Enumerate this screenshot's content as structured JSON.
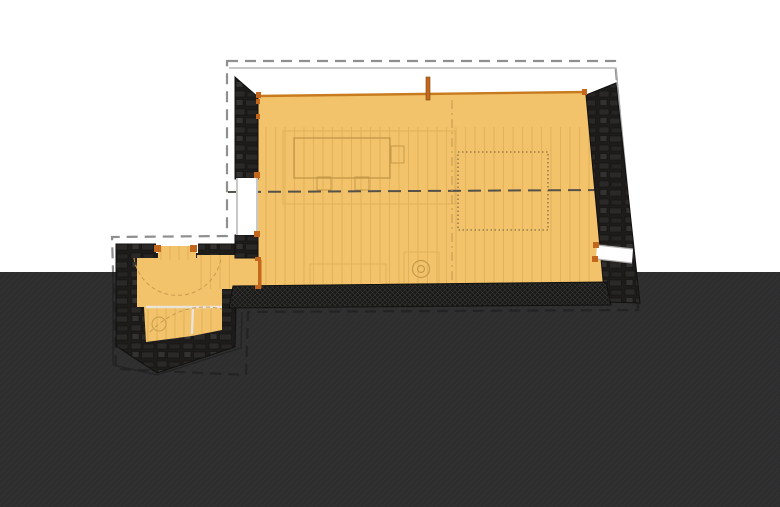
{
  "drawing": {
    "kind": "architectural-floor-plan",
    "colors": {
      "background": "#ffffff",
      "ground": "#2e2e2f",
      "ground_hatch": "#37373a",
      "floor": "#f2c36a",
      "floor_plank": "#dfae57",
      "furniture_outline": "#c49a4a",
      "platform_outline": "#e0b258",
      "accent_orange": "#c2671c",
      "threshold_orange": "#c77b1e",
      "stone_dark": "#1d1c1b",
      "stone_block": "#2b2927",
      "stone_block_light": "#343230",
      "dashed_outline_light": "#8f8f8f",
      "dashed_outline_dark": "#232324",
      "roofline_light": "#a8a8a8",
      "window_frame": "#b0b0b0",
      "white": "#ffffff",
      "section_line": "#54504a",
      "loft_dotted": "#6b5d3f",
      "swing_arc": "#c89b4f",
      "partition": "#e9e3d9",
      "hatch_joint": "#3a3a38"
    }
  }
}
